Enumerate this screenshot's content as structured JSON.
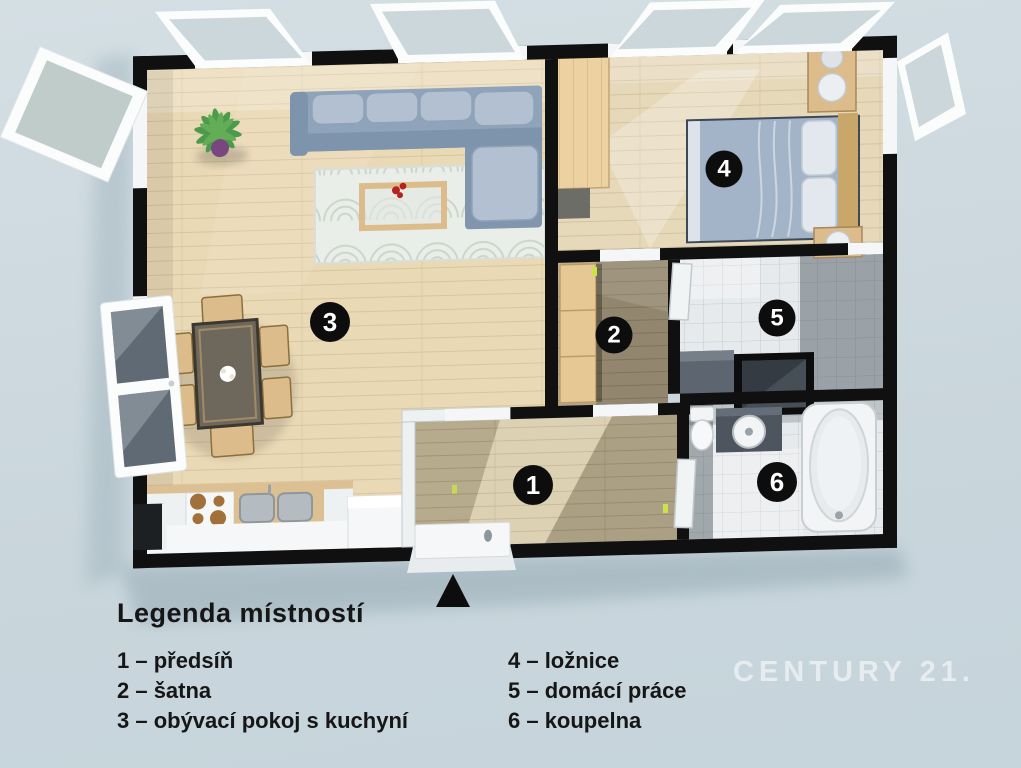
{
  "floorplan": {
    "rooms": [
      {
        "number": "1",
        "label": "předsíň"
      },
      {
        "number": "2",
        "label": "šatna"
      },
      {
        "number": "3",
        "label": "obývací pokoj s kuchyní"
      },
      {
        "number": "4",
        "label": "ložnice"
      },
      {
        "number": "5",
        "label": "domácí práce"
      },
      {
        "number": "6",
        "label": "koupelna"
      }
    ]
  },
  "legend": {
    "title": "Legenda místností",
    "left_items": [
      "1 – předsíň",
      "2 – šatna",
      "3 – obývací pokoj s kuchyní"
    ],
    "right_items": [
      "4 – ložnice",
      "5 – domácí práce",
      "6 – koupelna"
    ]
  },
  "watermark": "CENTURY 21.",
  "colors": {
    "background_top": "#d4dfe4",
    "background_bottom": "#c6d4db",
    "wall": "#101010",
    "white": "#f4f6f7",
    "wood_light": "#ead9b5",
    "wood_mid": "#d7c9a6",
    "wood_dark": "#b3a587",
    "wood_bedroom": "#e6d9ba",
    "tile": "#e7eaec",
    "tile_line": "#c6ccd0",
    "sofa": "#8fa3bb",
    "sofa_light": "#b3c0d2",
    "bed_blanket": "#a3b4c8",
    "rug": "#eaeee9",
    "rug_line": "#ccd5cc",
    "furniture_wood": "#dcbc8a",
    "dark_counter": "#4d555f",
    "badge": "#0d0d0d",
    "accent_red": "#b3241f",
    "plant_green": "#4c9a4c",
    "plant_pot": "#79477f",
    "glass": "#c2d0d4",
    "glass_dark": "#5f6a74",
    "shadow": "#9db0ba",
    "text": "#161616",
    "watermark": "rgba(255,255,255,0.55)"
  }
}
